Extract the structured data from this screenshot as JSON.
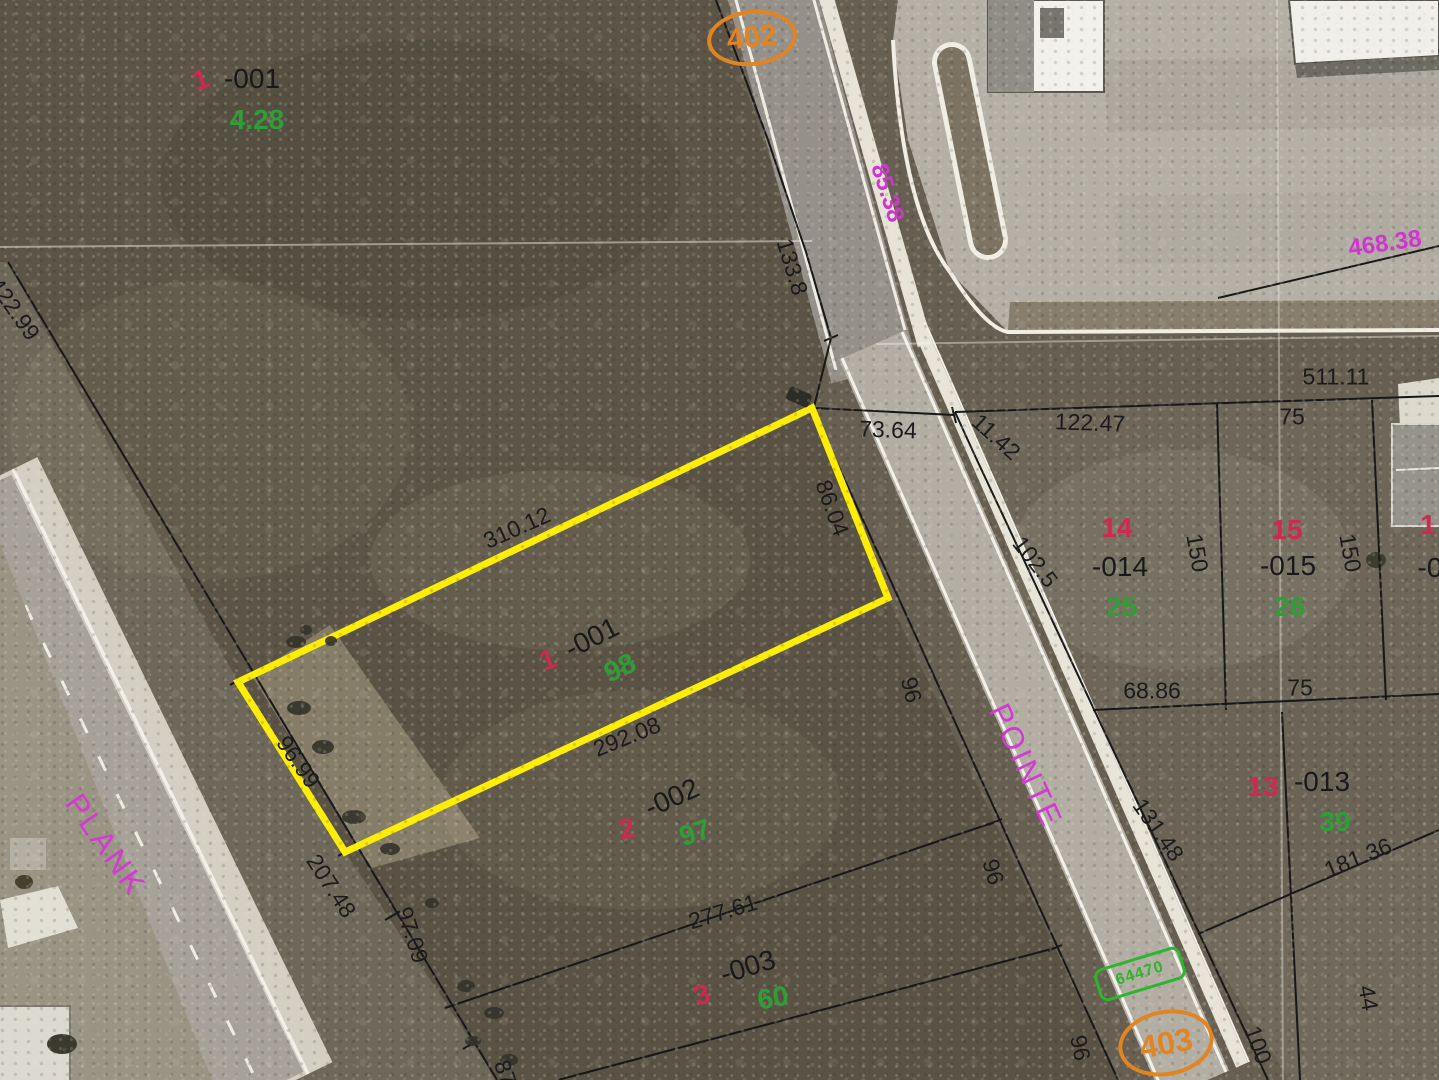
{
  "route_markers": {
    "r402": "402",
    "r403": "403",
    "green_tag": "64470"
  },
  "streets": {
    "west": "PLANK",
    "east": "POINTE"
  },
  "parcels": {
    "nw": {
      "lot": "1",
      "pin": "-001",
      "area": "4.28"
    },
    "center": {
      "lot": "1",
      "pin": "-001",
      "area": "98"
    },
    "p2": {
      "lot": "2",
      "pin": "-002",
      "area": "97"
    },
    "p3": {
      "lot": "3",
      "pin": "-003",
      "area": "60"
    },
    "p14": {
      "lot": "14",
      "pin": "-014",
      "area": "25"
    },
    "p15": {
      "lot": "15",
      "pin": "-015",
      "area": "26"
    },
    "p13": {
      "lot": "13",
      "pin": "-013",
      "area": "39"
    },
    "edge": {
      "lot": "1",
      "pin": "-0"
    }
  },
  "dimensions": {
    "a422_99": "422.99",
    "a133_8": "133.8",
    "a511_11": "511.11",
    "a73_64": "73.64",
    "a11_42": "11.42",
    "a122_47": "122.47",
    "a75a": "75",
    "a102_5": "102.5",
    "a150a": "150",
    "a150b": "150",
    "a310_12": "310.12",
    "a86_04": "86.04",
    "a96_99": "96.99",
    "a292_08": "292.08",
    "a96a": "96",
    "a68_86": "68.86",
    "a75b": "75",
    "a131_48": "131.48",
    "a181_36": "181.36",
    "a207_48": "207.48",
    "a97_09": "97.09",
    "a277_61": "277.61",
    "a96b": "96",
    "a96c": "96",
    "a100": "100",
    "a44": "44",
    "a87": "87"
  },
  "frontages_magenta": {
    "m85_38": "85.38",
    "m468_38": "468.38"
  }
}
